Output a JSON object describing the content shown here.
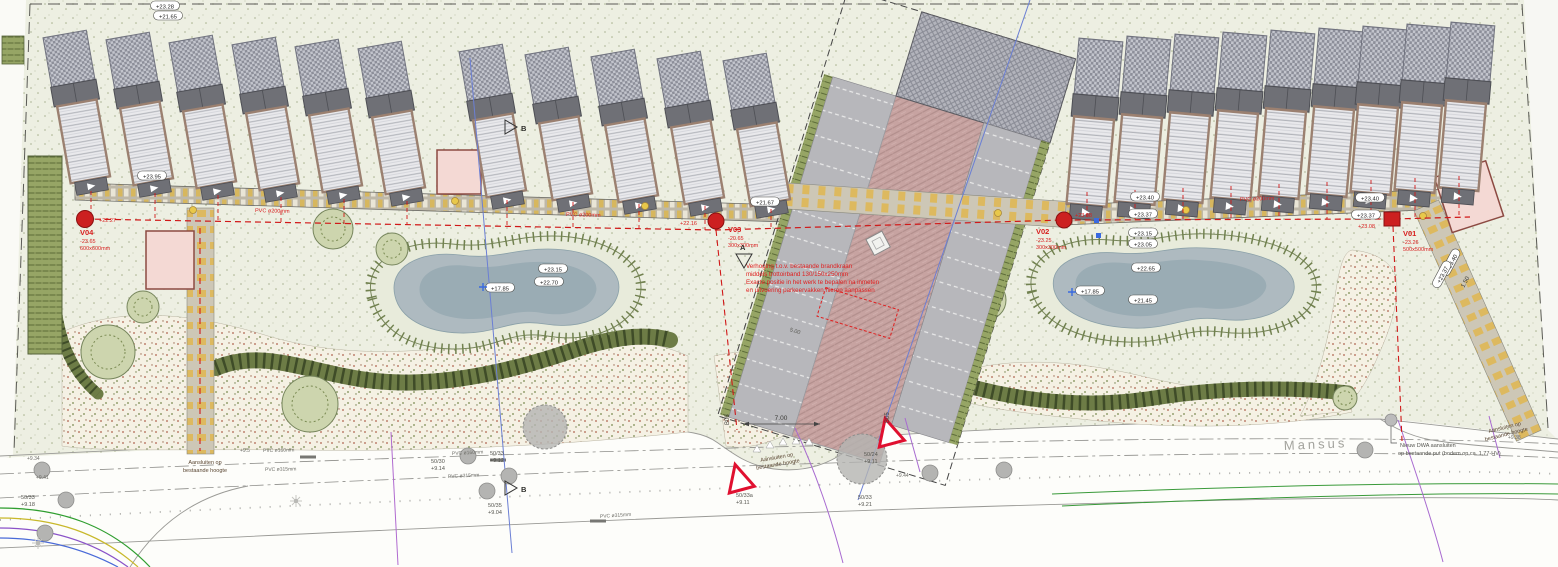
{
  "street": {
    "name": "Mansus"
  },
  "pits": [
    {
      "id": "V04",
      "level": "-23.65",
      "size": "600x600mm",
      "surface": "+22.27"
    },
    {
      "id": "V03",
      "level": "-20.65",
      "size": "300x300mm",
      "surface": "+22.16"
    },
    {
      "id": "V02",
      "level": "-23.25",
      "size": "300x300mm",
      "surface": "+23.08"
    },
    {
      "id": "V01",
      "level": "-23.26",
      "size": "500x500mm",
      "surface": "+23.08"
    }
  ],
  "red_note": {
    "l1": "Verhoging t.o.v. bestaande brandkraan",
    "l2": "middels trottoirband 130/150x250mm",
    "l3": "Exacte positie in het werk te bepalen na inmeten",
    "l4": "en uitvoering parkeervakken hierop aanpassen"
  },
  "notes": {
    "connect_1": "Aansluiten op",
    "connect_2": "bestaande hoogte",
    "dwa_1": "Nieuw DWA aansluiten",
    "dwa_2": "op bestaande put (bodem op ca. 1,77-HV)"
  },
  "pipes": {
    "drain": "PVC ø200mm",
    "d160": "PVC ø160mm",
    "d315": "PVC ø315mm"
  },
  "levels": {
    "p1": "+23.28",
    "p2": "+21.65",
    "p3": "+21.67",
    "p4": "+23.95",
    "l_bottom": "+17.85",
    "l_e1": "+23.15",
    "l_e2": "+22.70",
    "r_e1": "+23.15",
    "r_e2": "+23.05",
    "r_e3": "+22.65",
    "r_e4": "+21.45",
    "r_bottom": "+17.85",
    "w1": "+23.40",
    "w2": "+23.37",
    "w3": "+23.40",
    "w4": "+23.37",
    "path1": "+23.40",
    "path2": "+23.37",
    "s1": "+9.38",
    "s2": "+9.5",
    "s3": "+9.34",
    "s4": "+9.41",
    "s5": "+9.44"
  },
  "trees": {
    "t1": "50/33",
    "t1v": "+9.18",
    "t2": "50/30",
    "t2v": "+9.14",
    "t3": "50/33",
    "t3v": "+9.12",
    "t4": "50/35",
    "t4v": "+9.04",
    "t5": "50/33a",
    "t5v": "+9.11",
    "t6": "50/24",
    "t6v": "+9.11",
    "t7": "50/33",
    "t7v": "+9.21"
  },
  "markers": {
    "a": "A",
    "b": "B",
    "b05": "B05",
    "b06": "B06"
  },
  "dims": {
    "drive": "7.00",
    "stall": "5.00",
    "path": "1.50"
  }
}
